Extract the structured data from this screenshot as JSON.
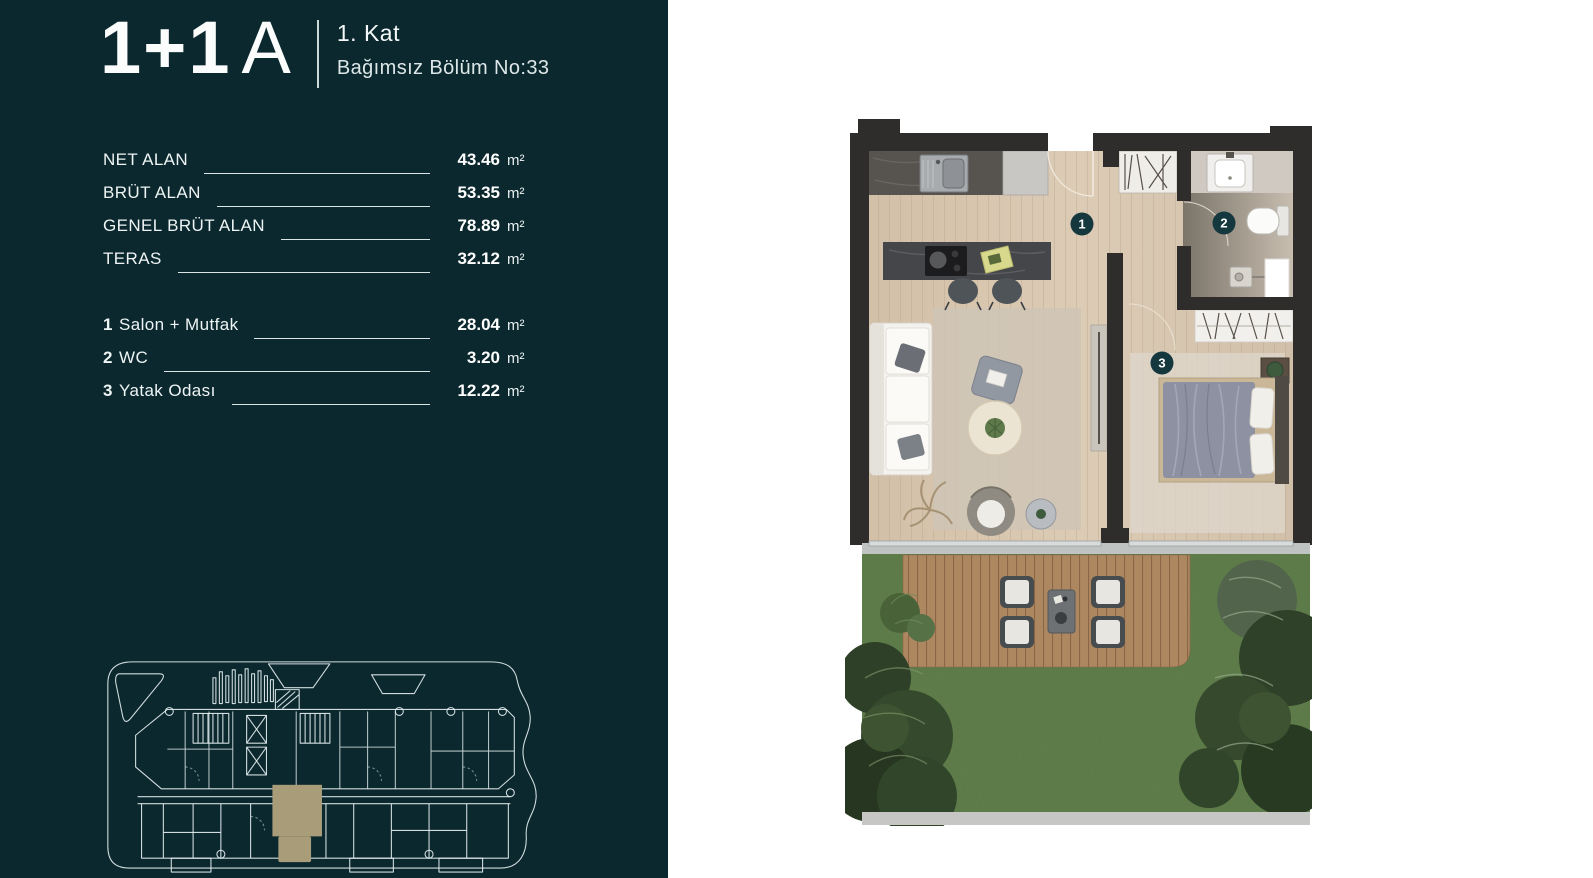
{
  "sidebar": {
    "title_main": "1+1",
    "title_variant": "A",
    "floor": "1. Kat",
    "unit_no": "Bağımsız Bölüm No:33",
    "areas": [
      {
        "label": "NET ALAN",
        "value": "43.46",
        "unit": "m²"
      },
      {
        "label": "BRÜT ALAN",
        "value": "53.35",
        "unit": "m²"
      },
      {
        "label": "GENEL BRÜT ALAN",
        "value": "78.89",
        "unit": "m²"
      },
      {
        "label": "TERAS",
        "value": "32.12",
        "unit": "m²"
      }
    ],
    "rooms": [
      {
        "num": "1",
        "label": "Salon + Mutfak",
        "value": "28.04",
        "unit": "m²"
      },
      {
        "num": "2",
        "label": "WC",
        "value": "3.20",
        "unit": "m²"
      },
      {
        "num": "3",
        "label": "Yatak Odası",
        "value": "12.22",
        "unit": "m²"
      }
    ]
  },
  "floorplan": {
    "markers": [
      {
        "num": "1"
      },
      {
        "num": "2"
      },
      {
        "num": "3"
      }
    ]
  },
  "colors": {
    "sidebar_bg": "#0b282e",
    "marker": "#15383f",
    "keyplan_highlight": "#a89c79",
    "wall": "#2e2d2b",
    "wood_floor": "#d8c7b1",
    "deck": "#ad8760",
    "grass": "#5e7d47"
  }
}
